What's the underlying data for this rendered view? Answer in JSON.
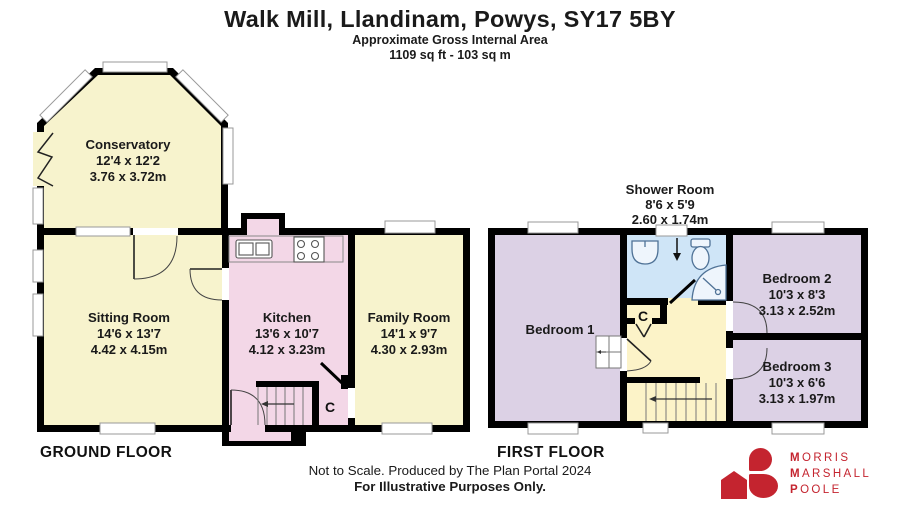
{
  "header": {
    "title": "Walk Mill, Llandinam, Powys, SY17 5BY",
    "subtitle1": "Approximate Gross Internal Area",
    "subtitle2": "1109 sq ft - 103 sq m"
  },
  "floors": {
    "ground": {
      "label": "GROUND FLOOR",
      "rooms": {
        "conservatory": {
          "name": "Conservatory",
          "imperial": "12'4 x 12'2",
          "metric": "3.76 x 3.72m"
        },
        "sitting_room": {
          "name": "Sitting Room",
          "imperial": "14'6 x 13'7",
          "metric": "4.42 x 4.15m"
        },
        "kitchen": {
          "name": "Kitchen",
          "imperial": "13'6 x 10'7",
          "metric": "4.12 x 3.23m"
        },
        "family_room": {
          "name": "Family Room",
          "imperial": "14'1 x 9'7",
          "metric": "4.30 x 2.93m"
        },
        "cupboard": "C"
      }
    },
    "first": {
      "label": "FIRST FLOOR",
      "rooms": {
        "bedroom1": {
          "name": "Bedroom 1"
        },
        "shower_room": {
          "name": "Shower Room",
          "imperial": "8'6 x 5'9",
          "metric": "2.60 x 1.74m"
        },
        "bedroom2": {
          "name": "Bedroom 2",
          "imperial": "10'3 x 8'3",
          "metric": "3.13 x 2.52m"
        },
        "bedroom3": {
          "name": "Bedroom 3",
          "imperial": "10'3 x 6'6",
          "metric": "3.13 x 1.97m"
        },
        "cupboard": "C"
      }
    }
  },
  "footer": {
    "line1": "Not to Scale. Produced by The Plan Portal 2024",
    "line2": "For Illustrative Purposes Only."
  },
  "logo": {
    "lines": [
      {
        "first": "M",
        "rest": "ORRIS"
      },
      {
        "first": "M",
        "rest": "ARSHALL"
      },
      {
        "first": "P",
        "rest": "OOLE"
      }
    ]
  },
  "colors": {
    "wall": "#000000",
    "room_yellow": "#f7f3cd",
    "room_pink": "#f3d7e7",
    "room_lavender": "#dcd1e5",
    "room_blue": "#cfe5f7",
    "room_cream": "#fcf3c8",
    "logo_red": "#c4242f"
  }
}
